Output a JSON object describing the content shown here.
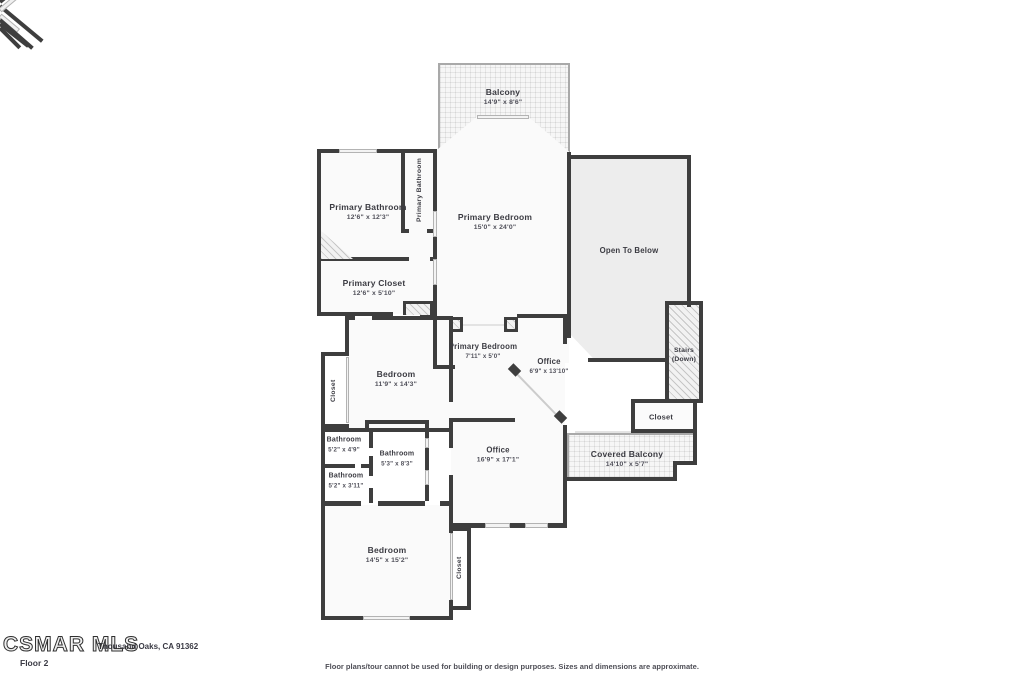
{
  "rooms": {
    "balcony": {
      "name": "Balcony",
      "dims": "14'9\" x 8'6\""
    },
    "primary_bathroom": {
      "name": "Primary Bathroom",
      "dims": "12'6\" x 12'3\""
    },
    "primary_bathroom_wc": {
      "name": "Primary Bathroom"
    },
    "primary_bedroom": {
      "name": "Primary Bedroom",
      "dims": "15'0\" x 24'0\""
    },
    "open_to_below": {
      "name": "Open To Below"
    },
    "primary_closet": {
      "name": "Primary Closet",
      "dims": "12'6\" x 5'10\""
    },
    "bedroom_mid": {
      "name": "Bedroom",
      "dims": "11'9\" x 14'3\""
    },
    "closet_mid": {
      "name": "Closet"
    },
    "primary_bedroom_hall": {
      "name": "Primary Bedroom",
      "dims": "7'11\" x 5'0\""
    },
    "office_small": {
      "name": "Office",
      "dims": "6'9\" x 13'10\""
    },
    "stairs": {
      "name": "Stairs",
      "dims": "(Down)"
    },
    "closet_right": {
      "name": "Closet"
    },
    "bathroom_top": {
      "name": "Bathroom",
      "dims": "5'2\" x 4'9\""
    },
    "bathroom_mid": {
      "name": "Bathroom",
      "dims": "5'3\" x 8'3\""
    },
    "bathroom_bottom": {
      "name": "Bathroom",
      "dims": "5'2\" x 3'11\""
    },
    "office_large": {
      "name": "Office",
      "dims": "16'9\" x 17'1\""
    },
    "covered_balcony": {
      "name": "Covered Balcony",
      "dims": "14'10\" x 5'7\""
    },
    "bedroom_bottom": {
      "name": "Bedroom",
      "dims": "14'5\" x 15'2\""
    },
    "closet_bottom": {
      "name": "Closet"
    }
  },
  "footer": {
    "watermark": "CSMAR MLS",
    "address": "Thousand Oaks, CA 91362",
    "floor_label": "Floor 2",
    "disclaimer": "Floor plans/tour cannot be used for building or design purposes. Sizes and dimensions are approximate."
  },
  "colors": {
    "wall": "#3e3e3e",
    "room_fill": "#fafafa",
    "open_to_below_fill": "#ededed",
    "label_text": "#3b3b42"
  }
}
